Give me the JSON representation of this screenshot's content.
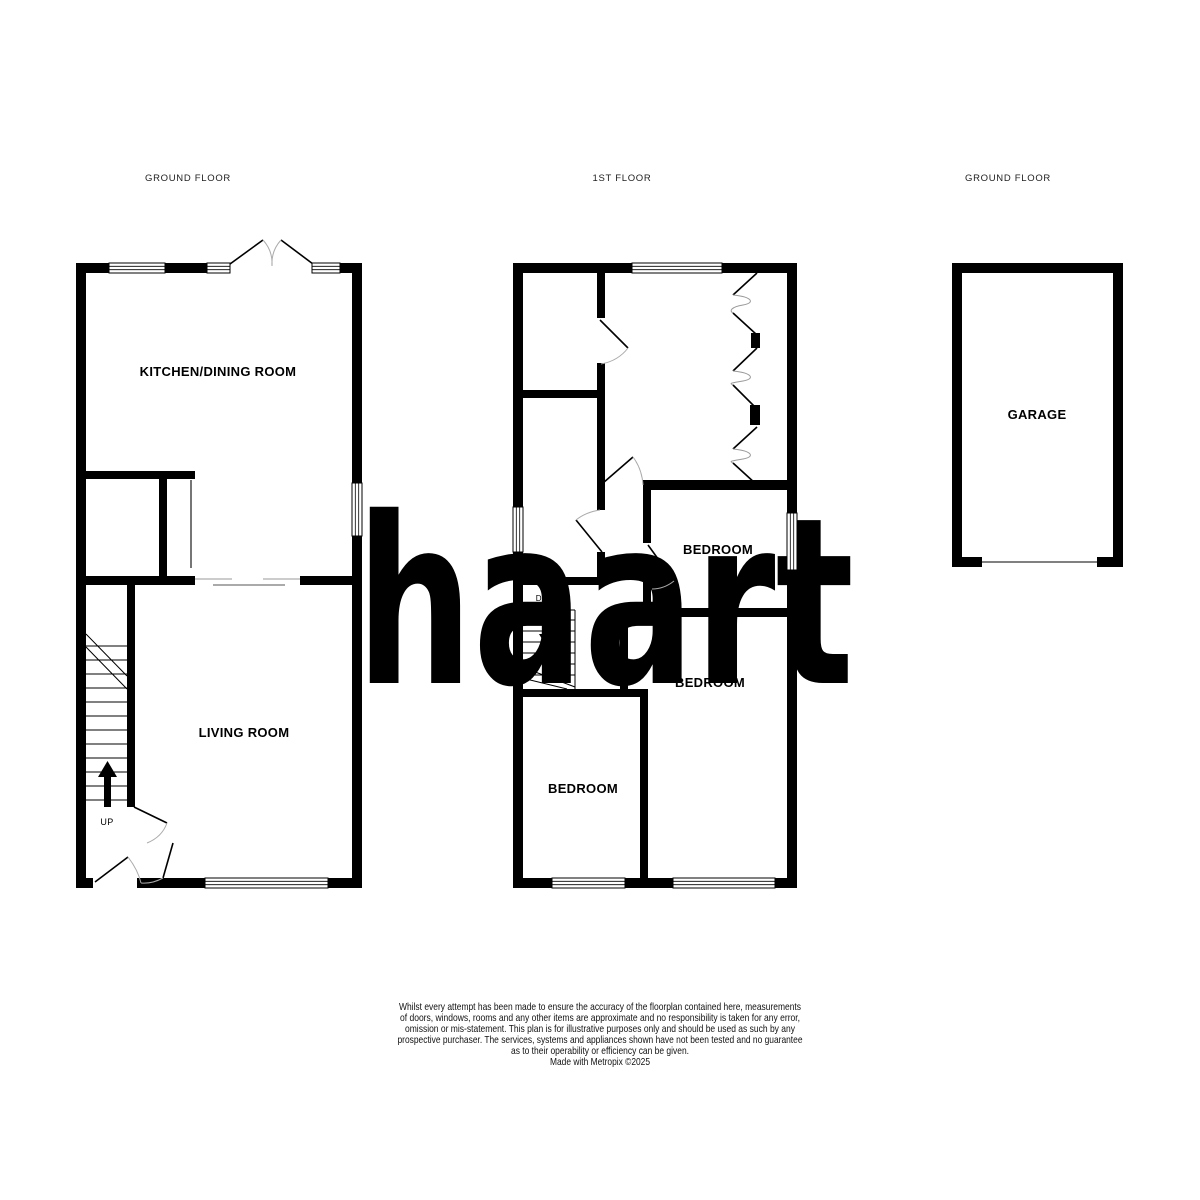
{
  "branding": {
    "logo_text": "haart",
    "logo_color": "#8B80D1"
  },
  "floor_plans": {
    "ground_floor_left": {
      "floor_label": "GROUND FLOOR",
      "rooms": {
        "kitchen_dining": "KITCHEN/DINING ROOM",
        "living_room": "LIVING ROOM"
      },
      "stair_label": "UP"
    },
    "first_floor": {
      "floor_label": "1ST FLOOR",
      "rooms": {
        "bedroom_1": "BEDROOM",
        "bedroom_2": "BEDROOM",
        "bedroom_3": "BEDROOM"
      },
      "stair_label": "DOWN"
    },
    "ground_floor_right": {
      "floor_label": "GROUND FLOOR",
      "rooms": {
        "garage": "GARAGE"
      }
    }
  },
  "disclaimer": {
    "lines": [
      "Whilst every attempt has been made to ensure the accuracy of the floorplan contained here, measurements",
      "of doors, windows, rooms and any other items are approximate and no responsibility is taken for any error,",
      "omission or mis-statement. This plan is for illustrative purposes only and should be used as such by any",
      "prospective purchaser. The services, systems and appliances shown have not been tested and no guarantee",
      "as to their operability or efficiency can be given.",
      "Made with Metropix ©2025"
    ]
  }
}
